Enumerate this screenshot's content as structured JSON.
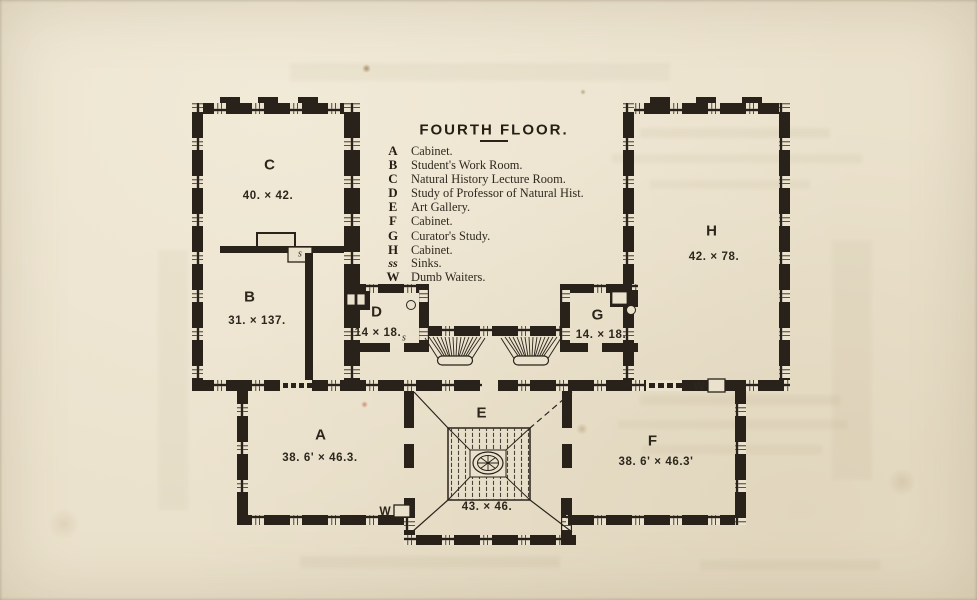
{
  "title": {
    "text": "FOURTH FLOOR."
  },
  "legend": {
    "entries": [
      {
        "key": "A",
        "label": "Cabinet."
      },
      {
        "key": "B",
        "label": "Student's Work Room."
      },
      {
        "key": "C",
        "label": "Natural History Lecture Room."
      },
      {
        "key": "D",
        "label": "Study of Professor of Natural Hist."
      },
      {
        "key": "E",
        "label": "Art Gallery."
      },
      {
        "key": "F",
        "label": "Cabinet."
      },
      {
        "key": "G",
        "label": "Curator's Study."
      },
      {
        "key": "H",
        "label": "Cabinet."
      },
      {
        "key": "ss",
        "label": "Sinks."
      },
      {
        "key": "W",
        "label": "Dumb Waiters."
      }
    ]
  },
  "rooms": {
    "A": {
      "letter": "A",
      "dims": "38. 6' × 46.3."
    },
    "B": {
      "letter": "B",
      "dims": "31. × 137."
    },
    "C": {
      "letter": "C",
      "dims": "40. × 42."
    },
    "D": {
      "letter": "D",
      "dims": "14 × 18."
    },
    "E": {
      "letter": "E",
      "dims": "43. × 46."
    },
    "F": {
      "letter": "F",
      "dims": "38. 6' × 46.3'"
    },
    "G": {
      "letter": "G",
      "dims": "14. × 18."
    },
    "H": {
      "letter": "H",
      "dims": "42. × 78."
    }
  },
  "annotations": {
    "sink_closet": "s",
    "sink_study": "s",
    "dumb_waiter_south": "W",
    "dumb_waiter_east": "W"
  },
  "colors": {
    "paper": "#ebe2cd",
    "ink": "#28221a"
  }
}
